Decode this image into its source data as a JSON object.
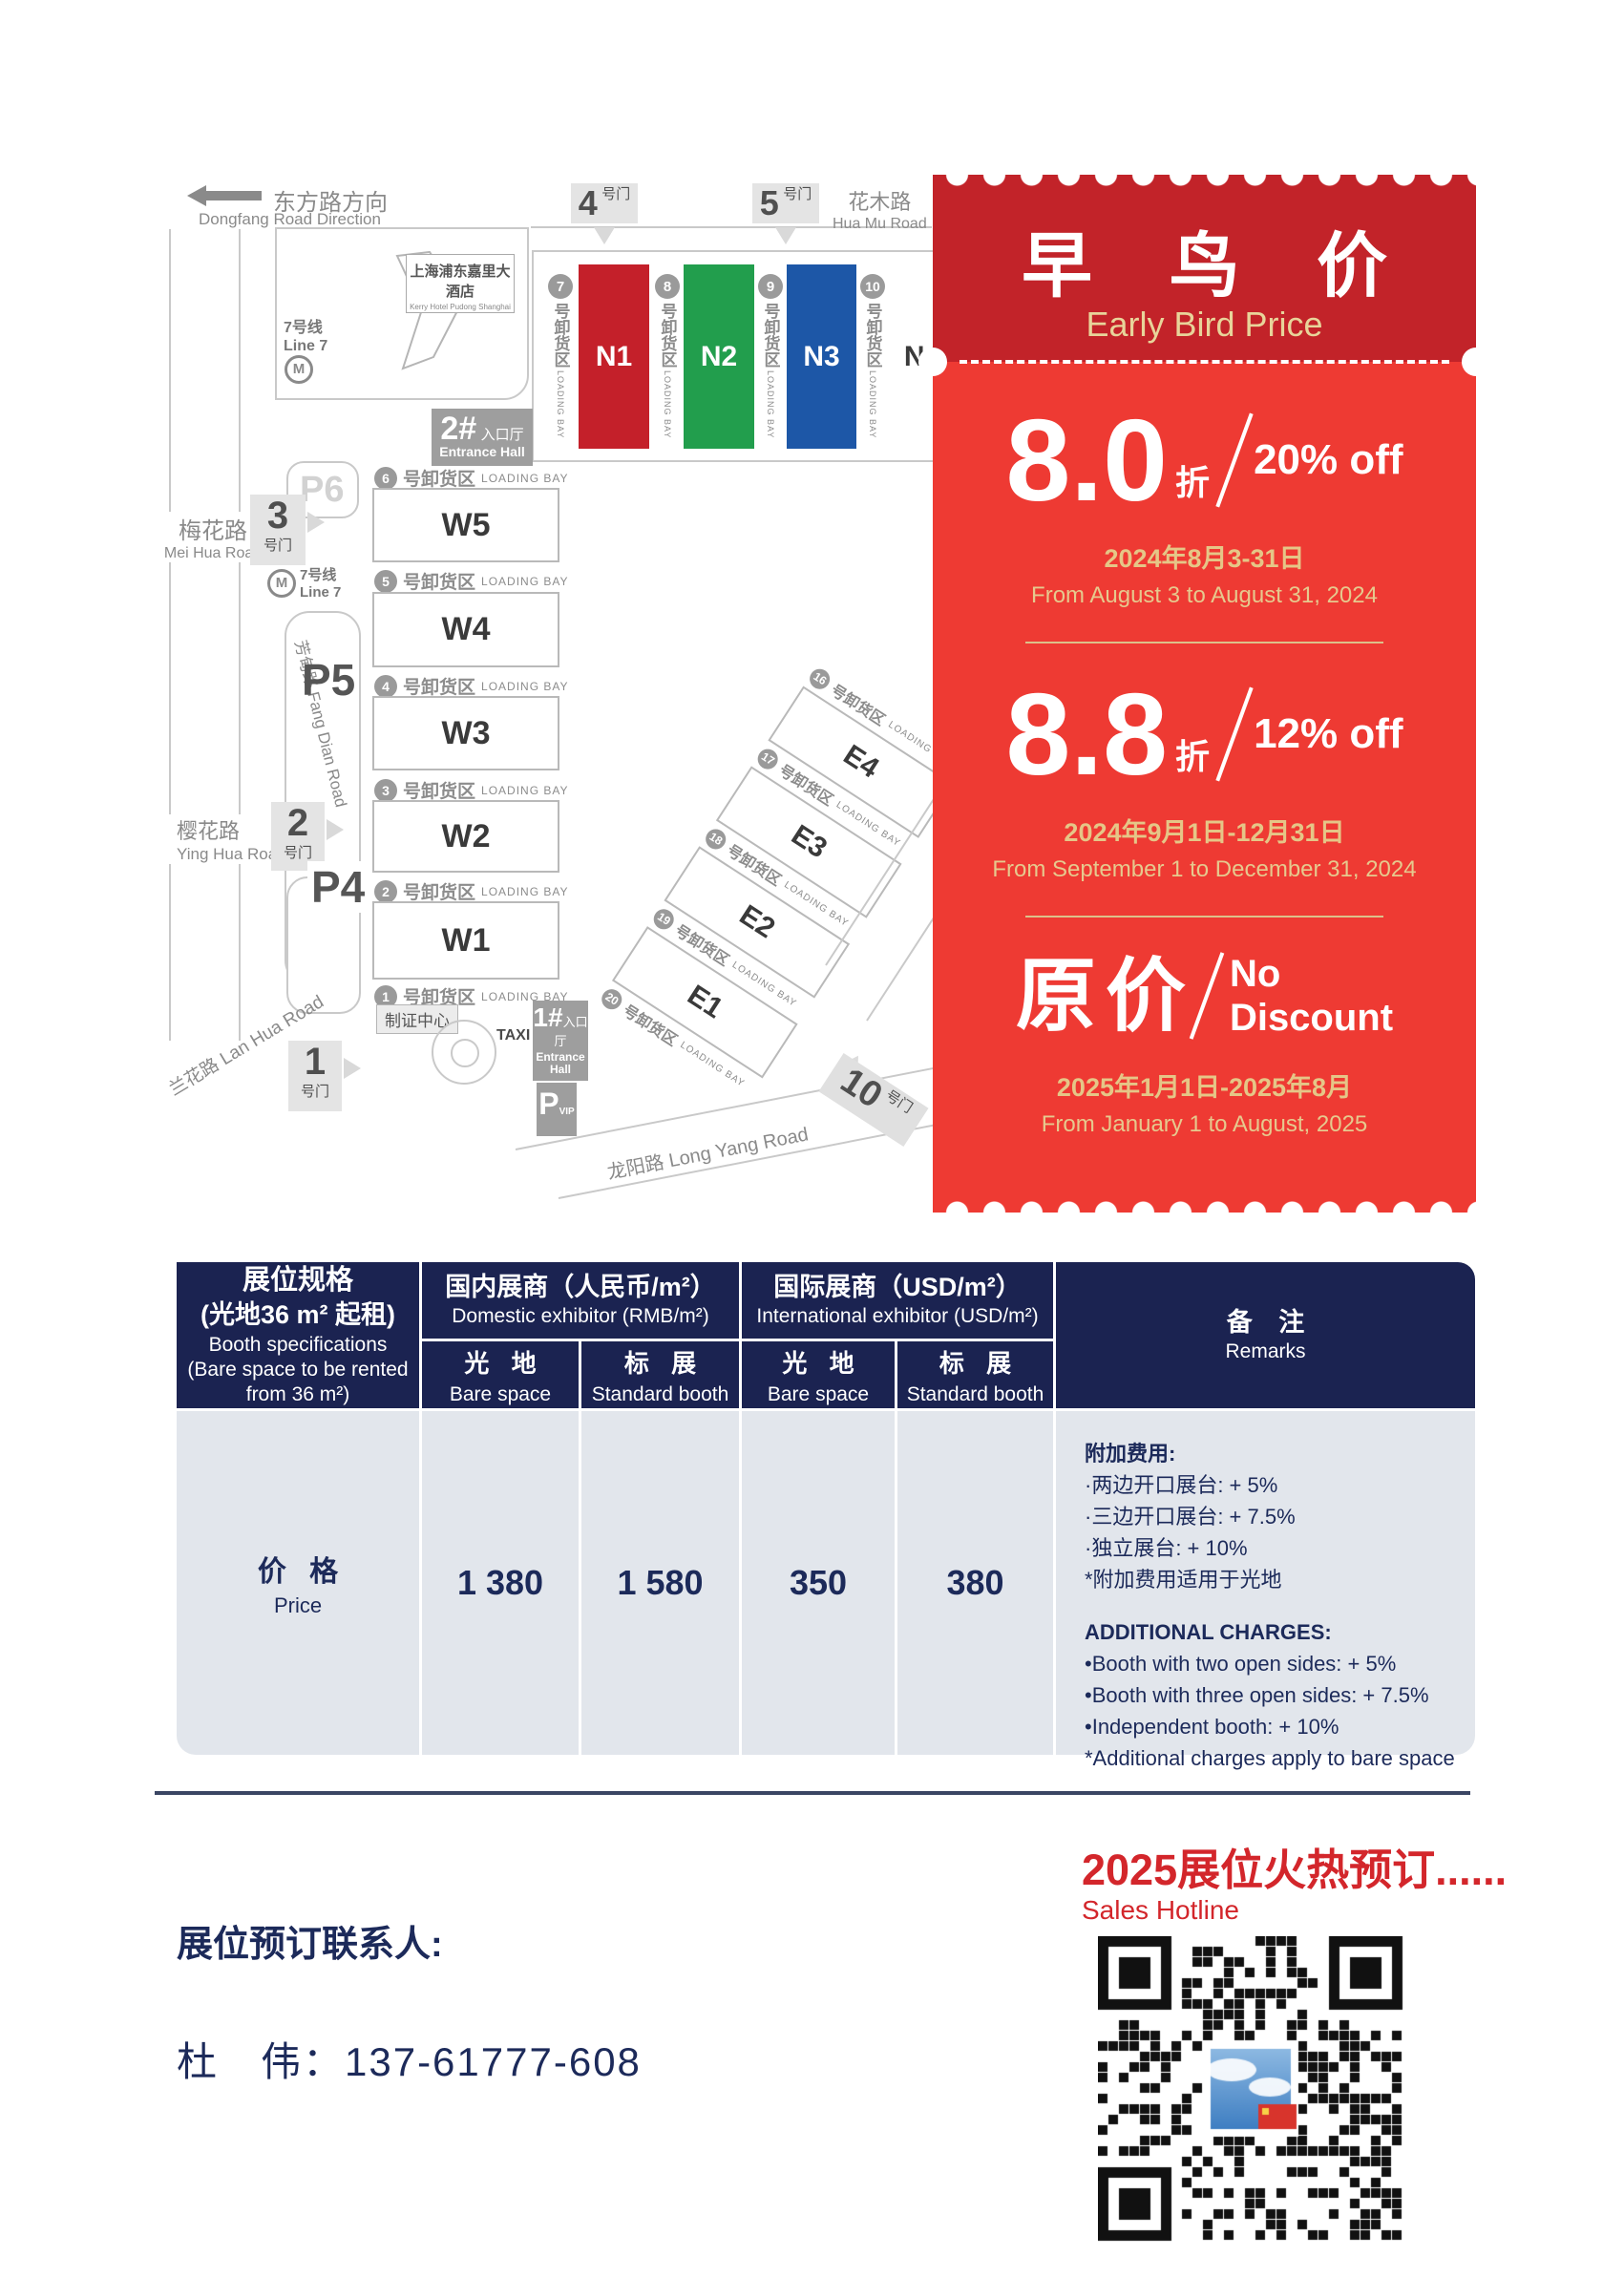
{
  "map": {
    "direction_cn": "东方路方向",
    "direction_en": "Dongfang Road Direction",
    "roads": {
      "huamu_cn": "花木路",
      "huamu_en": "Hua Mu Road",
      "meihua_cn": "梅花路",
      "meihua_en": "Mei Hua Road",
      "fangdian": "芳甸路 Fang Dian Road",
      "yinghua_cn": "樱花路",
      "yinghua_en": "Ying Hua Road",
      "lanhua": "兰花路 Lan Hua Road",
      "longyang": "龙阳路  Long Yang Road"
    },
    "gate_suffix": "号门",
    "gates": {
      "g1": "1",
      "g2": "2",
      "g3": "3",
      "g4": "4",
      "g5": "5",
      "g10": "10"
    },
    "hotel_cn": "上海浦东嘉里大酒店",
    "hotel_en": "Kerry Hotel Pudong Shanghai",
    "metro_cn": "7号线",
    "metro_en": "Line 7",
    "metro_letter": "M",
    "entrance2_num": "2#",
    "entrance2_cn": "入口厅",
    "entrance2_en": "Entrance Hall",
    "entrance1_num": "1#",
    "entrance1_cn": "入口厅",
    "entrance1_en": "Entrance Hall",
    "taxi": "TAXI",
    "badge_center": "制证中心",
    "parking": {
      "p6": "P6",
      "p5": "P5",
      "p4": "P4",
      "pvip": "P",
      "pvip_sub": "VIP"
    },
    "bay_cn": "号卸货区",
    "bay_en": "LOADING BAY",
    "north_bays": [
      "7",
      "8",
      "9",
      "10"
    ],
    "north_halls": [
      {
        "label": "N1",
        "color": "#c4202a"
      },
      {
        "label": "N2",
        "color": "#229e4d"
      },
      {
        "label": "N3",
        "color": "#1d57a7"
      },
      {
        "label": "N4",
        "color": "#ffffff"
      }
    ],
    "west_bays": [
      "6",
      "5",
      "4",
      "3",
      "2",
      "1"
    ],
    "west_halls": [
      "W5",
      "W4",
      "W3",
      "W2",
      "W1"
    ],
    "east_bays": [
      "16",
      "17",
      "18",
      "19",
      "20"
    ],
    "east_halls": [
      "E4",
      "E3",
      "E2",
      "E1"
    ]
  },
  "coupon": {
    "title_cn": "早 鸟 价",
    "title_en": "Early Bird Price",
    "header_color": "#c22329",
    "body_color": "#ee3a33",
    "gold_color": "#e5c687",
    "tiers": [
      {
        "big": "8.0",
        "unit": "折",
        "pct": "20% off",
        "date_cn": "2024年8月3-31日",
        "date_en": "From August 3 to August 31, 2024"
      },
      {
        "big": "8.8",
        "unit": "折",
        "pct": "12% off",
        "date_cn": "2024年9月1日-12月31日",
        "date_en": "From September 1 to December 31, 2024"
      },
      {
        "big": "原价",
        "pct_line1": "No",
        "pct_line2": "Discount",
        "date_cn": "2025年1月1日-2025年8月",
        "date_en": "From January 1 to August, 2025"
      }
    ]
  },
  "table": {
    "spec": {
      "cn1": "展位规格",
      "cn2": "(光地36 m² 起租)",
      "en1": "Booth specifications",
      "en2": "(Bare space to be rented",
      "en3": "from 36 m²)"
    },
    "domestic_cn": "国内展商（人民币/m²）",
    "domestic_en": "Domestic exhibitor (RMB/m²)",
    "intl_cn": "国际展商（USD/m²）",
    "intl_en": "International exhibitor (USD/m²)",
    "bare_cn": "光 地",
    "bare_en": "Bare space",
    "std_cn": "标 展",
    "std_en": "Standard booth",
    "remarks_cn": "备 注",
    "remarks_en": "Remarks",
    "price_cn": "价 格",
    "price_en": "Price",
    "values": [
      "1 380",
      "1 580",
      "350",
      "380"
    ],
    "remarks": {
      "cn_title": "附加费用:",
      "cn_item1": "·两边开口展台: + 5%",
      "cn_item2": "·三边开口展台: + 7.5%",
      "cn_item3": "·独立展台: + 10%",
      "cn_note": "*附加费用适用于光地",
      "en_title": "ADDITIONAL CHARGES:",
      "en_item1": "•Booth with two open sides: + 5%",
      "en_item2": "•Booth with three open sides: + 7.5%",
      "en_item3": "•Independent booth: + 10%",
      "en_note": "*Additional charges apply to bare space"
    }
  },
  "footer": {
    "hotline_cn": "2025展位火热预订......",
    "hotline_en": "Sales Hotline",
    "contact_label": "展位预订联系人:",
    "contact_value": "杜　伟：137-61777-608",
    "accent_color": "#d3262b"
  }
}
